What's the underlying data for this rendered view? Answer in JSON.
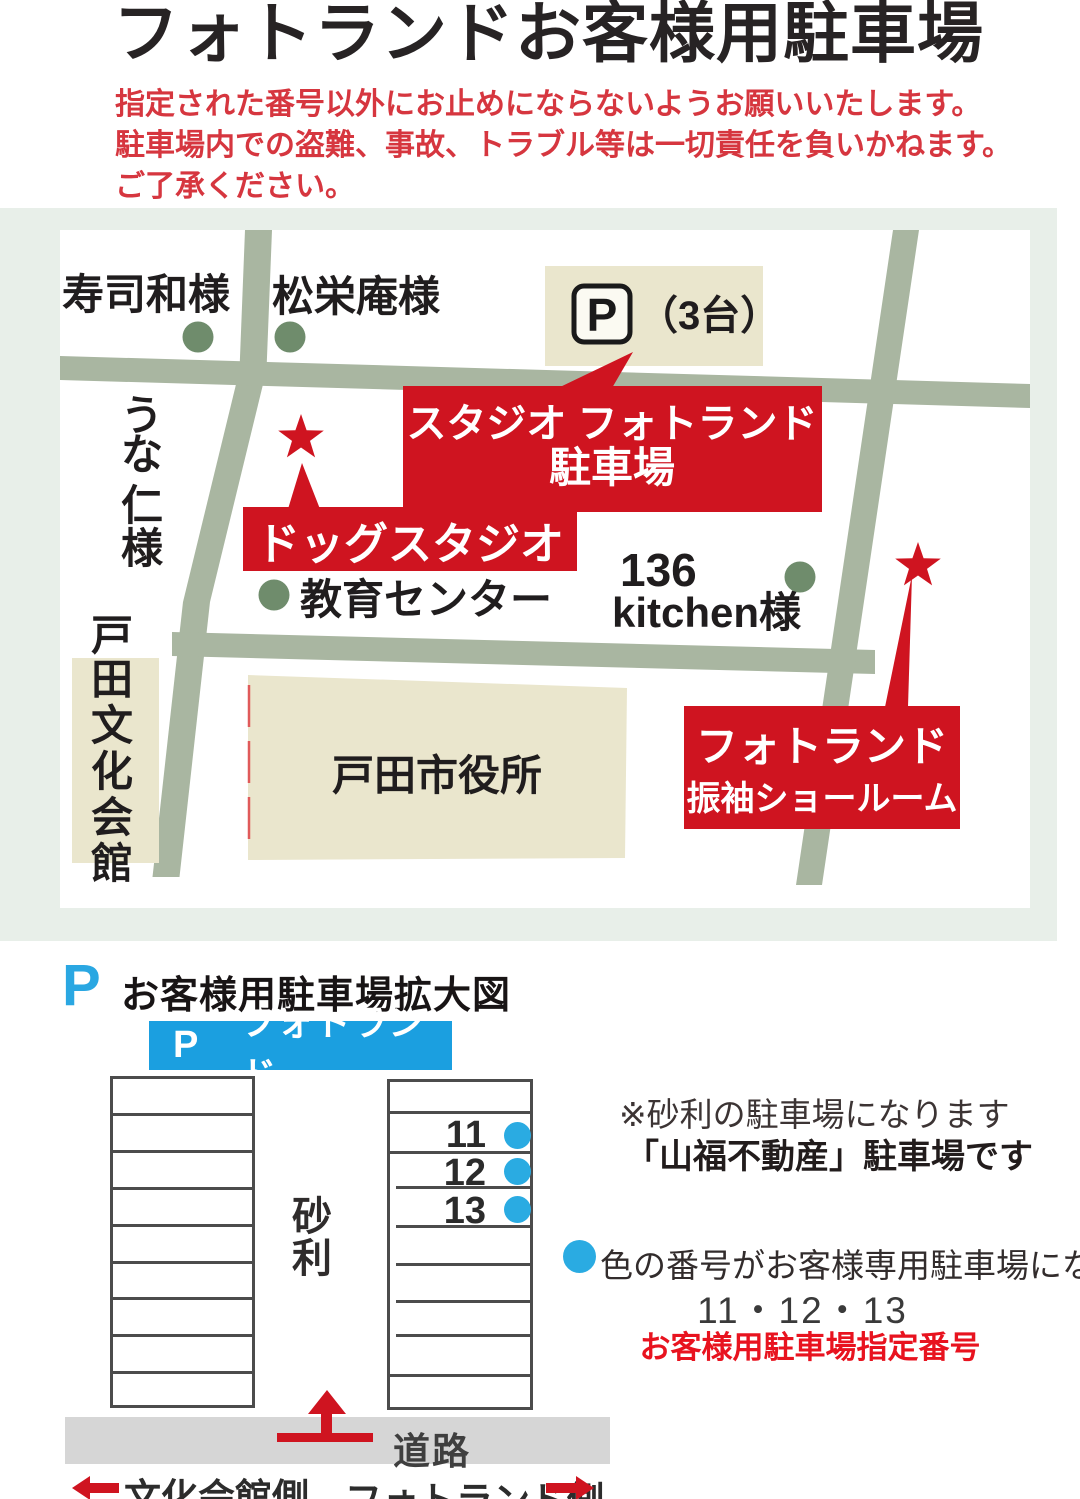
{
  "colors": {
    "accent_red": "#cf1420",
    "notice_red": "#d6363f",
    "banner_blue": "#1b9fe0",
    "dot_blue": "#2aabe2",
    "road_green": "#a9b6a1",
    "building_beige": "#eae6cd",
    "panel_mint": "#e8efe9",
    "road_gray": "#d6d6d6",
    "landmark_green": "#6f8c6c"
  },
  "header": {
    "title": "フォトランドお客様用駐車場",
    "notice_line1": "指定された番号以外にお止めにならないようお願いいたします。",
    "notice_line2": "駐車場内での盗難、事故、トラブル等は一切責任を負いかねます。",
    "notice_line3": "ご了承ください。"
  },
  "map": {
    "sushiwa_label": "寿司和様",
    "shoeian_label": "松栄庵様",
    "unani_chars": [
      "う",
      "な",
      "仁",
      "様"
    ],
    "bunkakaikan_chars": [
      "戸",
      "田",
      "文",
      "化",
      "会",
      "館"
    ],
    "p_sign": "P",
    "p_capacity": "（3台）",
    "studio_callout_line1": "スタジオ フォトランド",
    "studio_callout_line2": "駐車場",
    "dog_callout": "ドッグスタジオ",
    "kyoiku_label": "教育センター",
    "kitchen_line1": "136",
    "kitchen_line2": "kitchen様",
    "shiyakusho_label": "戸田市役所",
    "showroom_line1": "フォトランド",
    "showroom_line2": "振袖ショールーム"
  },
  "detail": {
    "p_icon": "P",
    "heading": "お客様用駐車場拡大図",
    "banner_p": "P",
    "banner_name": "フォトランド",
    "gravel_chars": [
      "砂",
      "利"
    ],
    "spots": [
      {
        "num": "11"
      },
      {
        "num": "12"
      },
      {
        "num": "13"
      }
    ],
    "note_line1": "※砂利の駐車場になります",
    "note_line2": "「山福不動産」駐車場です",
    "legend_text": "色の番号がお客様専用駐車場になります。",
    "numbers_line": "11・12・13",
    "red_note": "お客様用駐車場指定番号",
    "road_label": "道路",
    "left_direction": "文化会館側",
    "right_direction": "フォトランド側"
  }
}
